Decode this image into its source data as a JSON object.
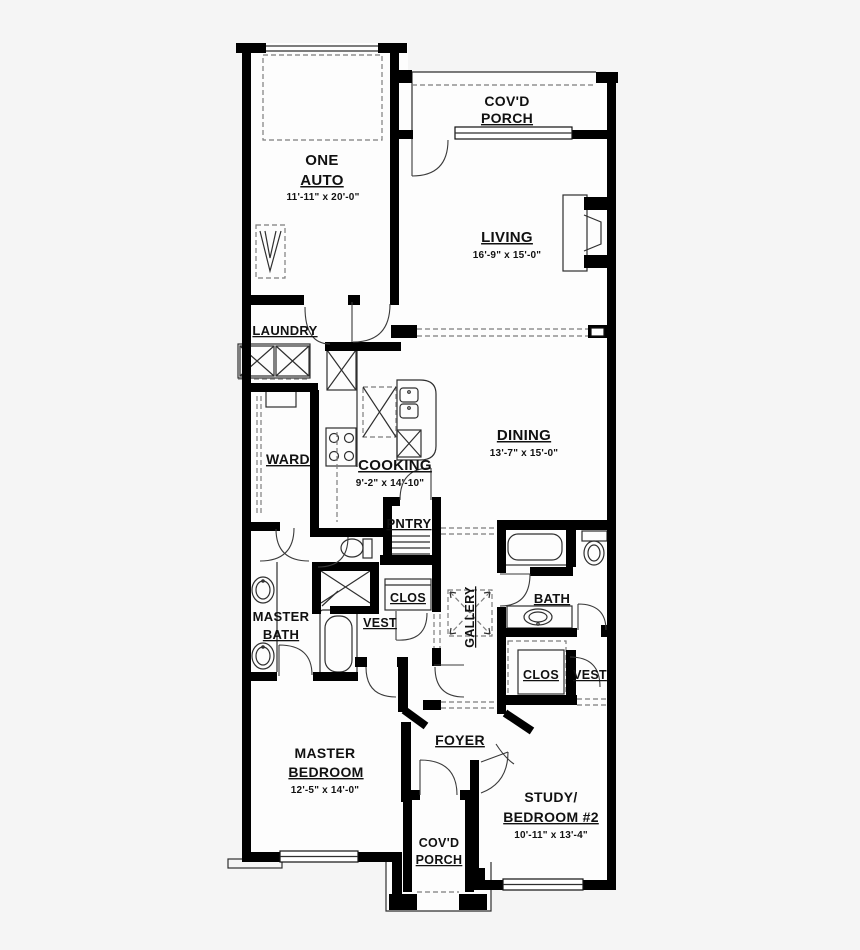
{
  "colors": {
    "background": "#f5f5f5",
    "wall": "#000000",
    "floor": "#fdfdfd",
    "line": "#2f2f2f",
    "dashed": "#7d7d7d"
  },
  "rooms": {
    "porch_top": {
      "line1": "COV'D",
      "line2": "PORCH"
    },
    "garage": {
      "line1": "ONE",
      "line2": "AUTO",
      "dims": "11'-11\"  x  20'-0\""
    },
    "living": {
      "name": "LIVING",
      "dims": "16'-9\"  x  15'-0\""
    },
    "laundry": {
      "name": "LAUNDRY"
    },
    "ward": {
      "name": "WARD"
    },
    "cooking": {
      "name": "COOKING",
      "dims": "9'-2\"  x  14'-10\""
    },
    "dining": {
      "name": "DINING",
      "dims": "13'-7\"  x  15'-0\""
    },
    "pantry": {
      "name": "PNTRY"
    },
    "master_bath": {
      "line1": "MASTER",
      "line2": "BATH"
    },
    "closet_master": {
      "name": "CLOS"
    },
    "vest_master": {
      "name": "VEST"
    },
    "gallery": {
      "name": "GALLERY"
    },
    "bath2": {
      "name": "BATH"
    },
    "closet2": {
      "name": "CLOS"
    },
    "vest2": {
      "name": "VEST"
    },
    "foyer": {
      "name": "FOYER"
    },
    "master_bedroom": {
      "line1": "MASTER",
      "line2": "BEDROOM",
      "dims": "12'-5\"  x  14'-0\""
    },
    "study": {
      "line1": "STUDY/",
      "line2": "BEDROOM #2",
      "dims": "10'-11\"  x  13'-4\""
    },
    "porch_bottom": {
      "line1": "COV'D",
      "line2": "PORCH"
    }
  }
}
